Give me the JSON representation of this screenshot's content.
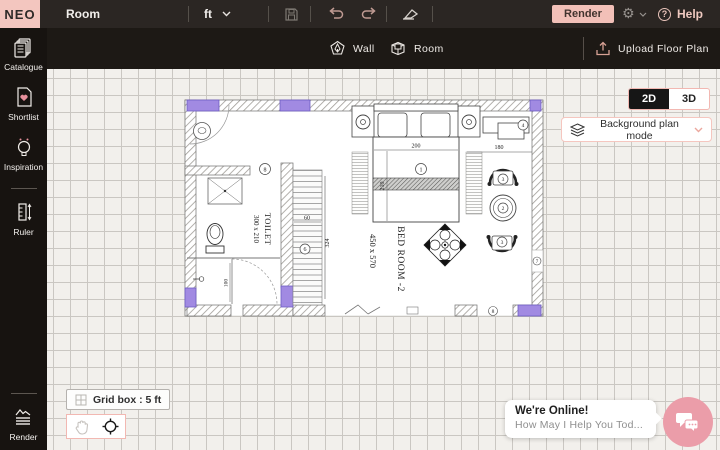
{
  "topbar": {
    "logo": "NEO",
    "title": "Room",
    "unit": "ft",
    "render": "Render",
    "help": "Help"
  },
  "sidebar": {
    "items": [
      {
        "label": "Catalogue"
      },
      {
        "label": "Shortlist"
      },
      {
        "label": "Inspiration"
      },
      {
        "label": "Ruler"
      }
    ],
    "render_label": "Render"
  },
  "tools": {
    "wall": "Wall",
    "room": "Room",
    "upload": "Upload Floor Plan"
  },
  "view": {
    "mode2d": "2D",
    "mode3d": "3D",
    "background_mode": "Background plan mode"
  },
  "canvas": {
    "grid_label": "Grid box : 5 ft"
  },
  "chat": {
    "status": "We're Online!",
    "message": "How May I Help You Tod..."
  },
  "plan": {
    "toilet": {
      "name": "TOILET",
      "size": "300 x 210"
    },
    "bedroom": {
      "name": "BED ROOM -2",
      "size": "450 x 570"
    },
    "dims": {
      "bed_w": "200",
      "bed_h": "210",
      "desk": "180",
      "toilet_w": "100",
      "stair_w": "60",
      "stair_h": "324"
    },
    "tags": {
      "t1": "1",
      "t2": "2",
      "t3": "3",
      "t4": "4",
      "t6": "6",
      "t7": "7",
      "t8": "8"
    }
  },
  "colors": {
    "accent": "#f2b8b2",
    "window_purple": "#a18ae2",
    "chat_pink": "#eb9da9",
    "toolbar_dark": "#2b2623"
  }
}
